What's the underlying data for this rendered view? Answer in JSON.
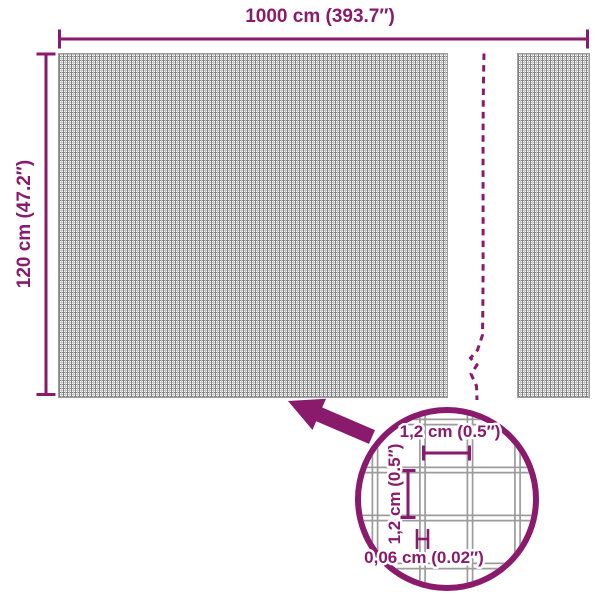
{
  "colors": {
    "accent": "#8A1A6B",
    "mesh_line": "#828282",
    "mesh_line_light": "#C4C4C4",
    "detail_wire": "#9C9C9C"
  },
  "overall_dimensions": {
    "width_label": "1000 cm (393.7″)",
    "height_label": "120 cm (47.2″)"
  },
  "detail_dimensions": {
    "cell_width_label": "1,2 cm (0.5″)",
    "cell_height_label": "1,2 cm (0.5″)",
    "wire_thickness_label": "0,06 cm (0.02″)"
  }
}
